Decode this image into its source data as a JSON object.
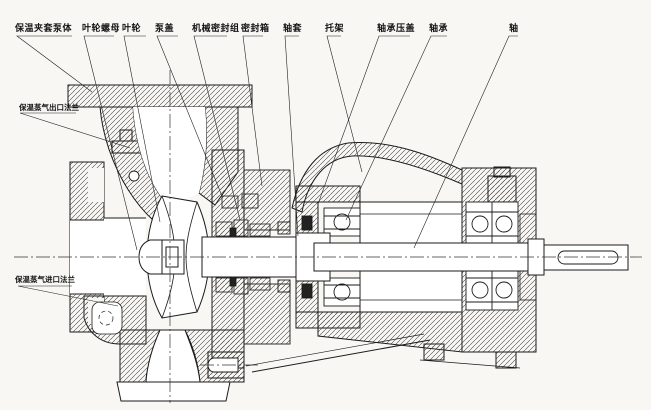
{
  "figure": {
    "kind": "pump-cross-section-engineering-drawing",
    "colors": {
      "background": "#f8f7f4",
      "line": "#1b1b1b",
      "hatch": "#3f3f3f",
      "centerline": "#333333"
    }
  },
  "labels": {
    "top": [
      {
        "id": "insulation-jacket-pump-body",
        "text": "保温夹套泵体"
      },
      {
        "id": "impeller-nut",
        "text": "叶轮螺母"
      },
      {
        "id": "impeller",
        "text": "叶轮"
      },
      {
        "id": "pump-cover",
        "text": "泵盖"
      },
      {
        "id": "mechanical-seal-assembly",
        "text": "机械密封组"
      },
      {
        "id": "seal-box",
        "text": "密封箱"
      },
      {
        "id": "shaft-sleeve",
        "text": "轴套"
      },
      {
        "id": "bracket",
        "text": "托架"
      },
      {
        "id": "bearing-gland",
        "text": "轴承压盖"
      },
      {
        "id": "bearing",
        "text": "轴承"
      },
      {
        "id": "shaft",
        "text": "轴"
      }
    ],
    "left": [
      {
        "id": "insulation-steam-outlet-flange",
        "text": "保温蒸气出口法兰"
      },
      {
        "id": "insulation-steam-inlet-flange",
        "text": "保温蒸气进口法兰"
      }
    ]
  }
}
